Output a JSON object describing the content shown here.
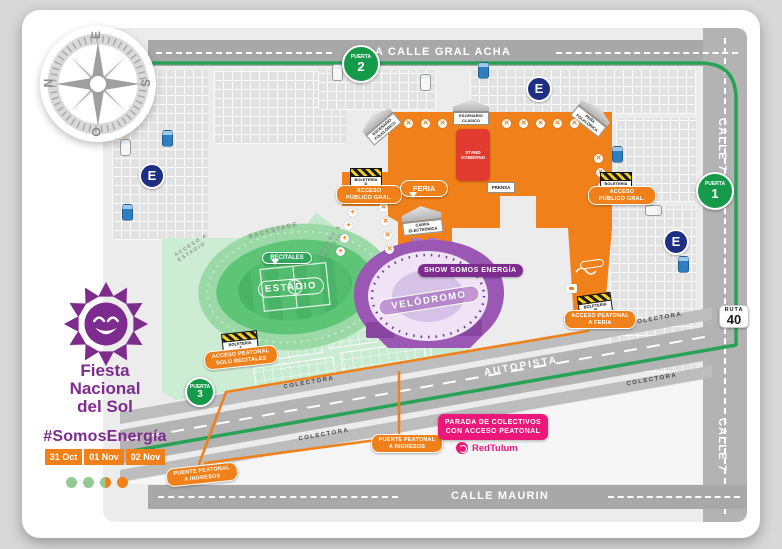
{
  "brand": {
    "title_line1": "Fiesta",
    "title_line2": "Nacional",
    "title_line3": "del Sol",
    "hashtag": "#SomosEnergía",
    "dates": [
      "31 Oct",
      "01 Nov",
      "02 Nov"
    ]
  },
  "compass": {
    "top": "E",
    "left": "N",
    "right": "S",
    "bottom": "O"
  },
  "streets": {
    "top": "A CALLE GRAL ACHA",
    "bottom": "CALLE MAURIN",
    "side": "CALLE 7",
    "highway": "AUTOPISTA",
    "collector": "COLECTORA"
  },
  "route_shield": {
    "label": "RUTA",
    "number": "40"
  },
  "gates": {
    "word": "PUERTA",
    "numbers": [
      "1",
      "2",
      "3"
    ]
  },
  "parking": {
    "letter": "E"
  },
  "venues": {
    "estadio": "ESTADIO",
    "estadio_bubble": "RECITALES",
    "velodromo": "VELÓDROMO",
    "velodromo_badge": "SHOW SOMOS ENERGÍA",
    "feria_bubble": "FERIA",
    "stand_gobierno": "STAND GOBIERNO",
    "escenario_folklorico": "ESCENARIO FOLKLÓRICO",
    "escenario_clasico": "ESCENARIO CLÁSICO",
    "pena_folklorica": "PEÑA FOLKLÓRICA",
    "carpa_electronica": "CARPA ELECTRÓNICA",
    "prensa": "PRENSA",
    "backstage": "BACKSTAGE",
    "acceso_estadio": "ACCESO A ESTADIO"
  },
  "access": {
    "publico_line1": "ACCESO",
    "publico_line2": "PÚBLICO GRAL.",
    "feria_line1": "ACCESO PEATONAL",
    "feria_line2": "A FERIA",
    "recitales_line1": "ACCESO PEATONAL",
    "recitales_line2": "SOLO RECITALES",
    "puente_line1": "PUENTE PEATONAL",
    "puente_line2": "A INGRESOS",
    "boleteria": "BOLETERÍA",
    "boleteria_letters": [
      "A",
      "B",
      "C",
      "D"
    ]
  },
  "transit": {
    "parada_line1": "PARADA DE COLECTIVOS",
    "parada_line2": "CON ACCESO PEATONAL",
    "operator": "RedTulum"
  },
  "icons": {
    "closed_gate": "✕",
    "open_gate": "+"
  },
  "colors": {
    "purple": "#7d2b8f",
    "orange": "#f08019",
    "green_route": "#27a257",
    "pink": "#ec1879",
    "parking_navy": "#1d2e83",
    "gate_green": "#159a49",
    "stadium_green": "#5ec577",
    "velodrome_purple": "#9a57b4",
    "stand_red": "#e23b30"
  }
}
